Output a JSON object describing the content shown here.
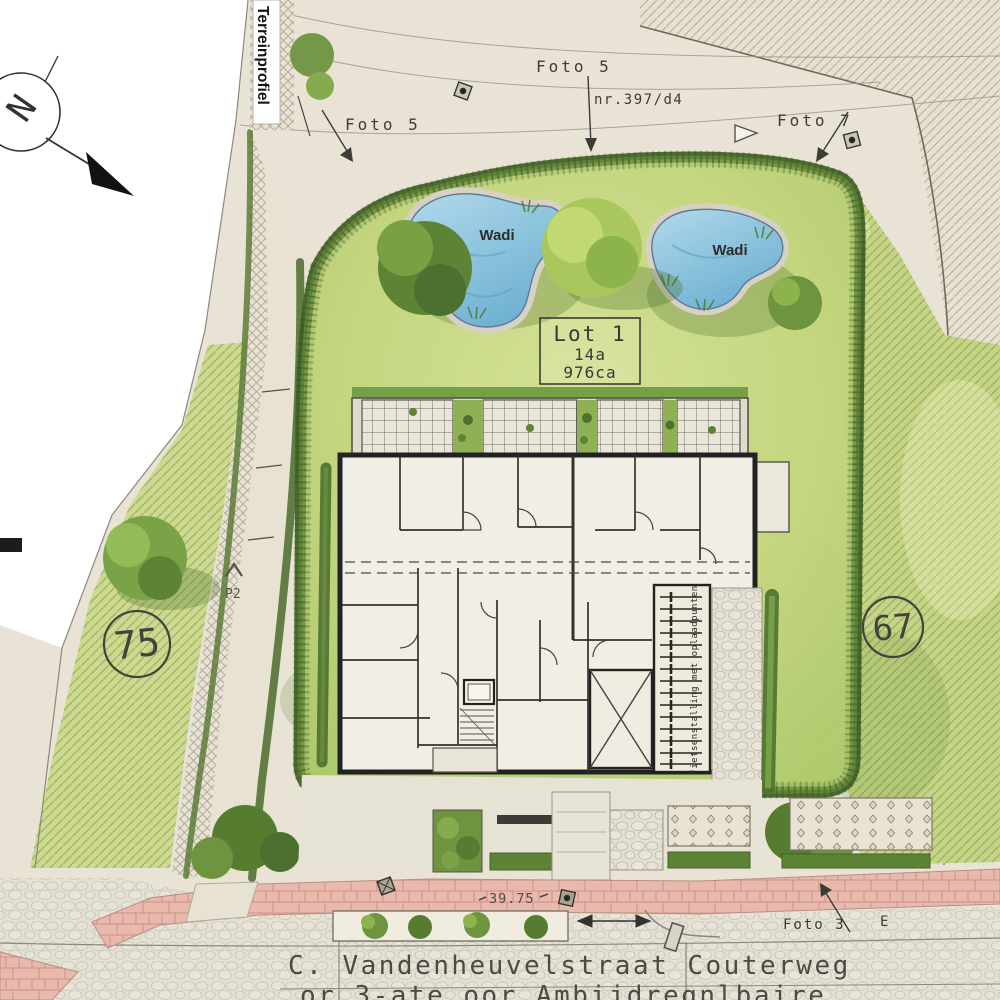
{
  "labels": {
    "terrain_profile": "Terreinprofiel",
    "compass_letter": "N",
    "foto5_top": "Foto 5",
    "foto5_left": "Foto 5",
    "foto7": "Foto 7",
    "foto3": "Foto 3",
    "parcel_number": "nr.397/d4",
    "wadi_left": "Wadi",
    "wadi_right": "Wadi",
    "lot_line1": "Lot 1",
    "lot_line2": "14a",
    "lot_line3": "976ca",
    "parcel_left_number": "75",
    "parcel_right_number": "67",
    "p2": "P2",
    "bike_parking": "Fietsenstalling met oplaadpunten",
    "dimension_width": "39.75",
    "street_name": "C. Vandenheuvelstraat Couterweg",
    "street_name_line2": "or  3-ate oor Ambijdregnlbaire",
    "marker_e": "E"
  },
  "colors": {
    "paper": "#ffffff",
    "road": "#e9e3d5",
    "lawn": "#c3d57e",
    "hedge": "#4a6c2c",
    "water": "#8cc3dd",
    "sidewalk_pink": "#eab9ad",
    "wall": "#222222"
  }
}
